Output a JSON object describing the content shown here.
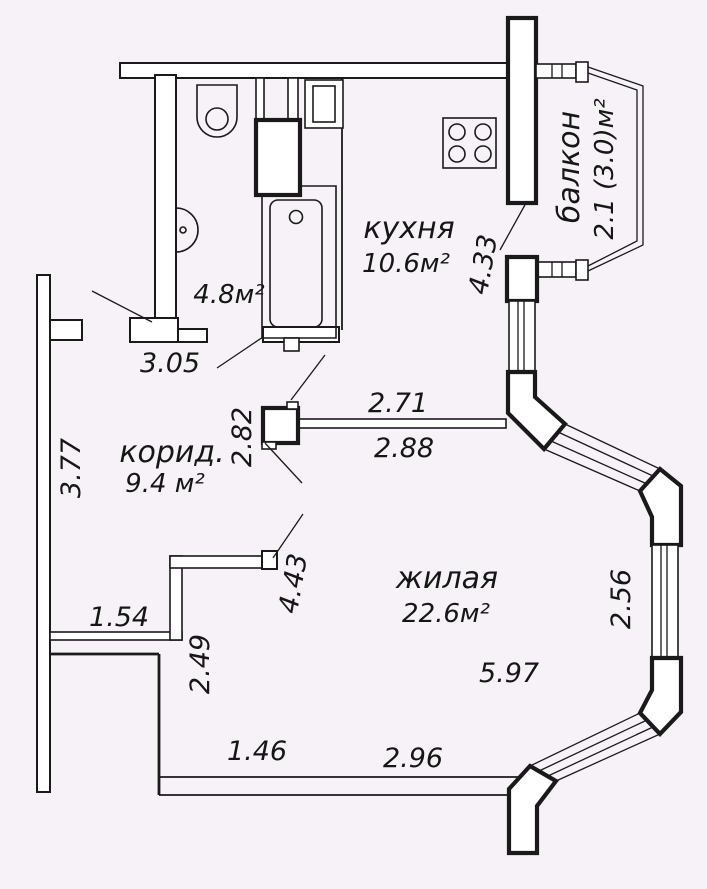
{
  "plan": {
    "background": "#f7f2f8",
    "line_color": "#1a1a1a",
    "rooms": {
      "kitchen": {
        "label": "кухня",
        "area": "10.6м²"
      },
      "bathroom": {
        "area": "4.8м²"
      },
      "corridor": {
        "label": "корид.",
        "area": "9.4 м²"
      },
      "living_room": {
        "label": "жилая",
        "area": "22.6м²"
      },
      "balcony": {
        "label": "балкон",
        "area": "2.1 (3.0)м²"
      }
    },
    "dimensions": {
      "entry": "3.05",
      "corridor_left": "3.77",
      "corridor_right": "2.82",
      "kitchen_top": "2.71",
      "kitchen_bottom": "2.88",
      "kitchen_right": "4.33",
      "living_upper_left": "4.43",
      "niche": "1.54",
      "living_left": "2.49",
      "living_bottom_small": "1.46",
      "living_bottom": "2.96",
      "living_width": "5.97",
      "bay_right": "2.56"
    }
  }
}
